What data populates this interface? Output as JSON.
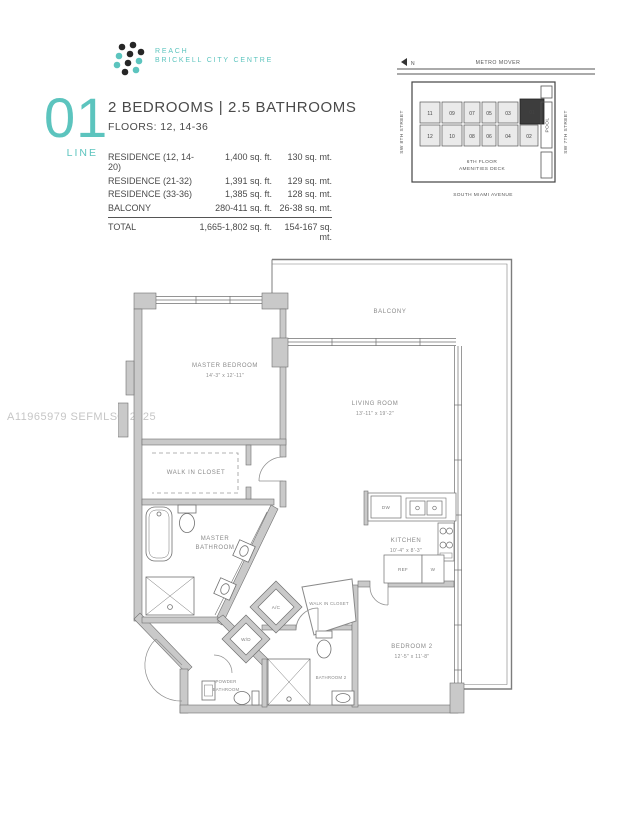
{
  "brand": {
    "logo_line1": "REACH",
    "logo_line2": "BRICKELL CITY CENTRE",
    "teal": "#5cc4be",
    "dot_dark": "#262626"
  },
  "header": {
    "line_number": "01",
    "line_label": "LINE",
    "title": "2 BEDROOMS  |  2.5 BATHROOMS",
    "floors": "FLOORS: 12, 14-36"
  },
  "spec_table": {
    "rows": [
      {
        "label": "RESIDENCE (12, 14-20)",
        "sqft": "1,400 sq. ft.",
        "sqmt": "130 sq. mt."
      },
      {
        "label": "RESIDENCE (21-32)",
        "sqft": "1,391 sq. ft.",
        "sqmt": "129 sq. mt."
      },
      {
        "label": "RESIDENCE (33-36)",
        "sqft": "1,385 sq. ft.",
        "sqmt": "128 sq. mt."
      },
      {
        "label": "BALCONY",
        "sqft": "280-411 sq. ft.",
        "sqmt": "26-38 sq. mt."
      }
    ],
    "total": {
      "label": "TOTAL",
      "sqft": "1,665-1,802 sq. ft.",
      "sqmt": "154-167 sq. mt."
    }
  },
  "keyplan": {
    "north_label": "N",
    "metro_mover": "METRO MOVER",
    "street_left": "SW 8TH STREET",
    "street_right": "SW 7TH STREET",
    "street_bottom": "SOUTH MIAMI AVENUE",
    "amenities_line1": "6TH FLOOR",
    "amenities_line2": "AMENITIES DECK",
    "pool": "POOL",
    "highlighted_unit": "01",
    "top_units": [
      "11",
      "09",
      "07",
      "05",
      "03",
      "01"
    ],
    "bottom_units": [
      "12",
      "10",
      "08",
      "06",
      "04",
      "02"
    ]
  },
  "watermark": "A11965979  SEFMLS© 2025",
  "floorplan": {
    "balcony": "BALCONY",
    "master_bedroom": {
      "name": "MASTER BEDROOM",
      "dim": "14'-3\" x 12'-11\""
    },
    "living_room": {
      "name": "LIVING ROOM",
      "dim": "13'-11\" x 19'-2\""
    },
    "kitchen": {
      "name": "KITCHEN",
      "dim": "10'-4\" x 8'-3\""
    },
    "bedroom2": {
      "name": "BEDROOM 2",
      "dim": "12'-5\" x 11'-8\""
    },
    "wic1": "WALK IN CLOSET",
    "wic2": "WALK IN CLOSET",
    "master_bath1": "MASTER",
    "master_bath2": "BATHROOM",
    "bathroom2": "BATHROOM 2",
    "powder1": "POWDER",
    "powder2": "BATHROOM",
    "ac": "A/C",
    "wd": "W/D",
    "dw": "DW",
    "ref": "REF",
    "w": "W"
  }
}
